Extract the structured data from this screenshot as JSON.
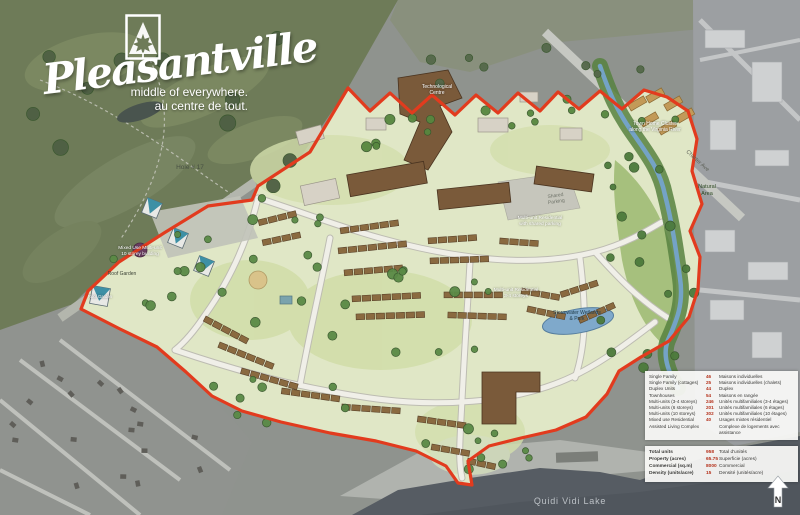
{
  "logo": {
    "name": "Pleasantville",
    "tagline_en": "middle of everywhere.",
    "tagline_fr": "au centre de tout.",
    "emblem": "maple-leaf-mountain"
  },
  "map_labels": {
    "hole_17": "Hole # 17",
    "technology_centre_line1": "Technological",
    "technology_centre_line2": "Centre",
    "townhome_cluster_line1": "Town Home Cluster",
    "townhome_cluster_line2": "along the Virginia River",
    "charter_ave": "Charter Ave",
    "natural_area_line1": "Natural",
    "natural_area_line2": "Area",
    "shared_parking_line1": "Shared",
    "shared_parking_line2": "Parking",
    "multi_unit_line1": "Multi-unit Residential",
    "multi_unit_line2": "with shared parking",
    "multi_unit2_line1": "Multi-unit Residential",
    "multi_unit2_line2": "3-4 storeys",
    "mixed_use_line1": "Mixed Use Multi-unit",
    "mixed_use_line2": "10 storey building",
    "roof_garden": "Roof Garden",
    "roof_garden_tower": "Roof Garden",
    "stormwater_line1": "Stormwater Wetlands",
    "stormwater_line2": "& Park",
    "quidi_vidi_lake": "Quidi Vidi Lake",
    "north": "N"
  },
  "legend": {
    "rows": [
      {
        "en": "Single Family",
        "count": "46",
        "fr": "Maisons individuelles"
      },
      {
        "en": "Single Family (cottages)",
        "count": "25",
        "fr": "Maisons individuelles (chalets)"
      },
      {
        "en": "Duplex Units",
        "count": "44",
        "fr": "Duplex"
      },
      {
        "en": "Townhouses",
        "count": "54",
        "fr": "Maisons en rangée"
      },
      {
        "en": "Multi-units (3-4 storeys)",
        "count": "246",
        "fr": "Unités multifamiliales (3-4 étages)"
      },
      {
        "en": "Multi-units (6 storeys)",
        "count": "201",
        "fr": "Unités multifamiliales (6 étages)"
      },
      {
        "en": "Multi-units (10 storeys)",
        "count": "302",
        "fr": "Unités multifamiliales (10 étages)"
      },
      {
        "en": "Mixed use Residential",
        "count": "40",
        "fr": "Usages mixtes résidentiel"
      },
      {
        "en": "Assisted Living Complex",
        "count": "",
        "fr": "Complexe de logements avec assistance"
      }
    ],
    "totals": [
      {
        "en": "Total units",
        "value": "958",
        "fr": "Total d'unités"
      },
      {
        "en": "Property (acres)",
        "value": "65.75",
        "fr": "Superficie (acres)"
      },
      {
        "en": "Commercial (sq.m)",
        "value": "8000",
        "fr": "Commercial"
      },
      {
        "en": "Density (units/acre)",
        "value": "15",
        "fr": "Densité (unités/acre)"
      }
    ]
  },
  "colors": {
    "boundary_red": "#e23b1e",
    "site_green": "#e0e7c6",
    "water_blue": "#74a3c6",
    "lake_gray": "#565c63",
    "legend_number_red": "#b5321c"
  }
}
